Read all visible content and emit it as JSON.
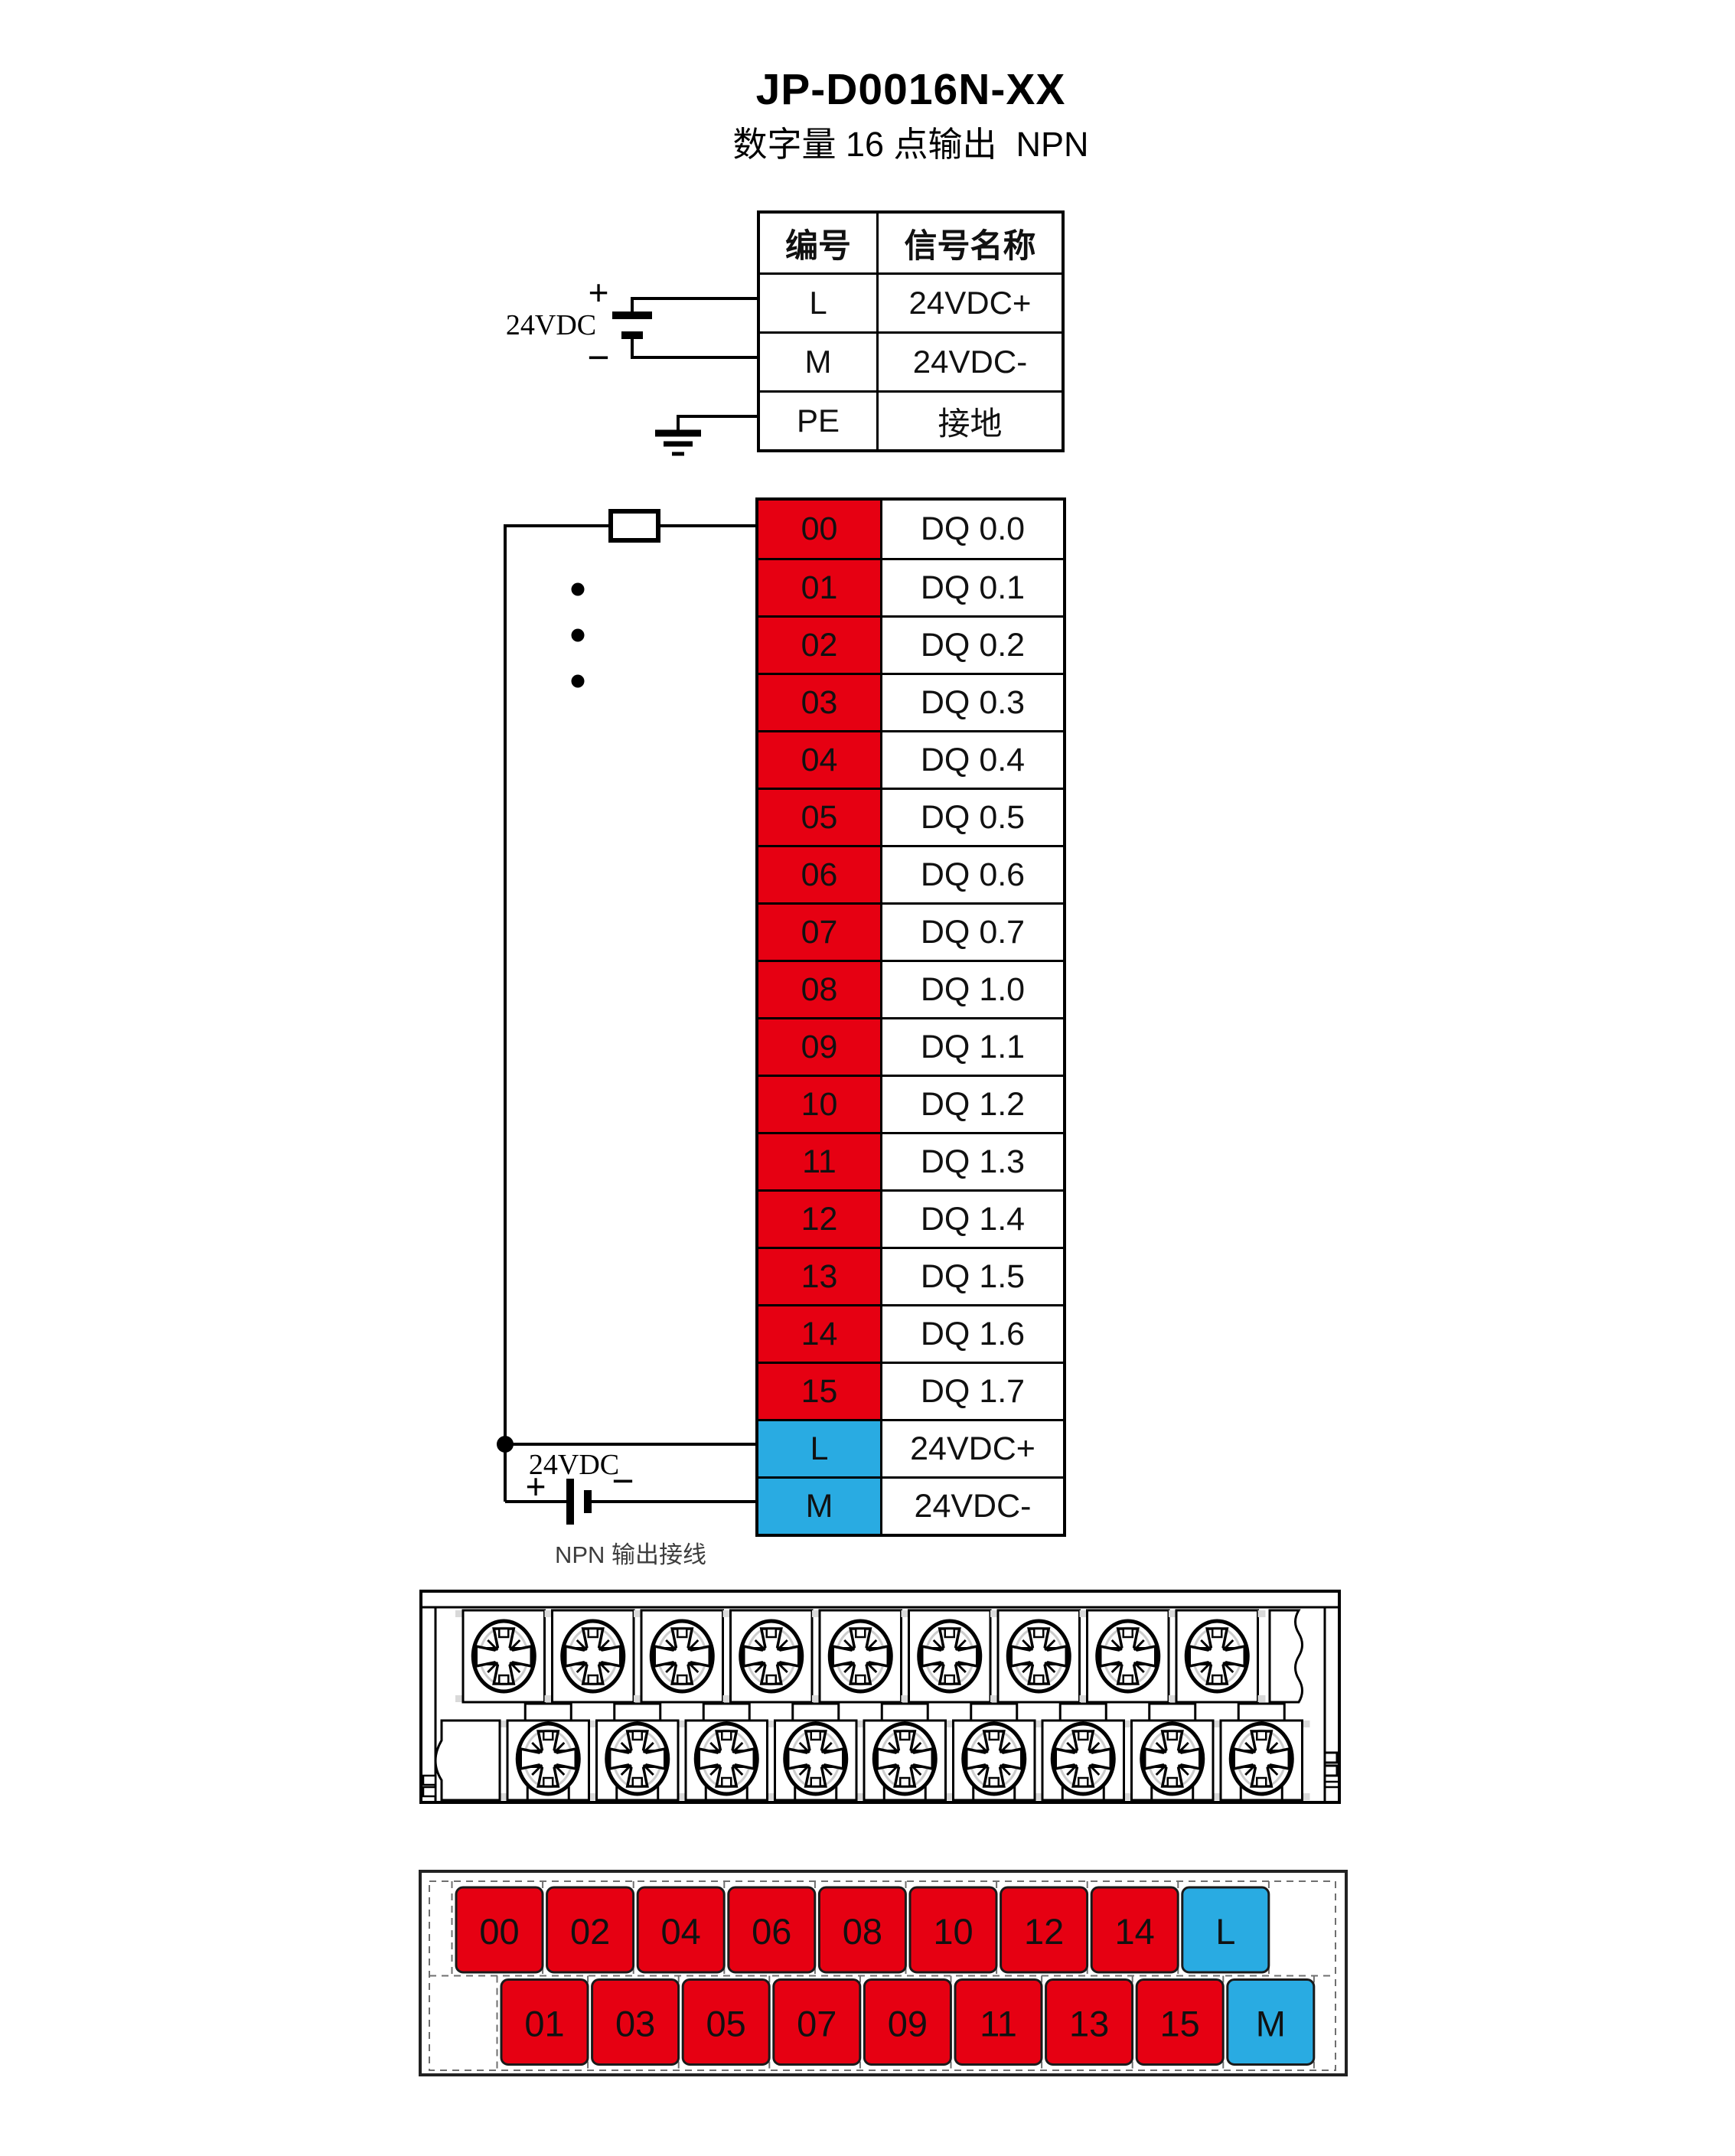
{
  "title": "JP-D0016N-XX",
  "subtitle": "数字量 16 点输出  NPN",
  "colors": {
    "red": "#e60012",
    "blue": "#29abe2",
    "line": "#000000"
  },
  "power_table": {
    "headers": [
      "编号",
      "信号名称"
    ],
    "rows": [
      [
        "L",
        "24VDC+"
      ],
      [
        "M",
        "24VDC-"
      ],
      [
        "PE",
        "接地"
      ]
    ]
  },
  "power_wiring": {
    "supply_label": "24VDC",
    "plus_label": "+",
    "minus_label": "−"
  },
  "output_table": {
    "rows": [
      {
        "no": "00",
        "name": "DQ 0.0",
        "color": "red"
      },
      {
        "no": "01",
        "name": "DQ 0.1",
        "color": "red"
      },
      {
        "no": "02",
        "name": "DQ 0.2",
        "color": "red"
      },
      {
        "no": "03",
        "name": "DQ 0.3",
        "color": "red"
      },
      {
        "no": "04",
        "name": "DQ 0.4",
        "color": "red"
      },
      {
        "no": "05",
        "name": "DQ 0.5",
        "color": "red"
      },
      {
        "no": "06",
        "name": "DQ 0.6",
        "color": "red"
      },
      {
        "no": "07",
        "name": "DQ 0.7",
        "color": "red"
      },
      {
        "no": "08",
        "name": "DQ 1.0",
        "color": "red"
      },
      {
        "no": "09",
        "name": "DQ 1.1",
        "color": "red"
      },
      {
        "no": "10",
        "name": "DQ 1.2",
        "color": "red"
      },
      {
        "no": "11",
        "name": "DQ 1.3",
        "color": "red"
      },
      {
        "no": "12",
        "name": "DQ 1.4",
        "color": "red"
      },
      {
        "no": "13",
        "name": "DQ 1.5",
        "color": "red"
      },
      {
        "no": "14",
        "name": "DQ 1.6",
        "color": "red"
      },
      {
        "no": "15",
        "name": "DQ 1.7",
        "color": "red"
      },
      {
        "no": "L",
        "name": "24VDC+",
        "color": "blue"
      },
      {
        "no": "M",
        "name": "24VDC-",
        "color": "blue"
      }
    ]
  },
  "output_wiring": {
    "supply_label": "24VDC",
    "plus_label": "+",
    "minus_label": "−",
    "caption": "NPN 输出接线"
  },
  "terminal_map": {
    "top_row": [
      "00",
      "02",
      "04",
      "06",
      "08",
      "10",
      "12",
      "14",
      "L"
    ],
    "bottom_row": [
      "01",
      "03",
      "05",
      "07",
      "09",
      "11",
      "13",
      "15",
      "M"
    ]
  }
}
